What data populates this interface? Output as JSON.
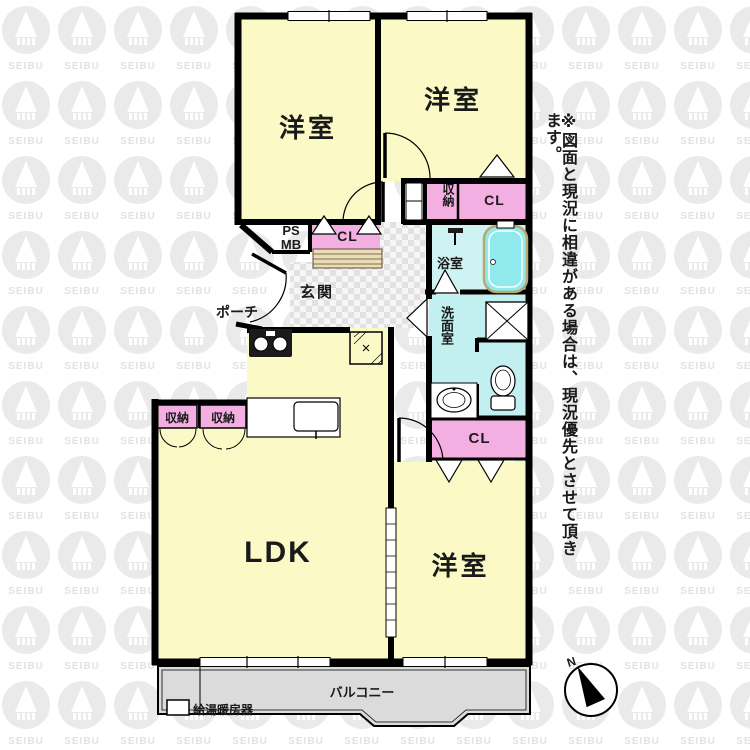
{
  "page": {
    "watermark_brand": "SEIBU"
  },
  "floorplan": {
    "rooms": {
      "bedroom_nw": {
        "label": "洋室"
      },
      "bedroom_ne": {
        "label": "洋室"
      },
      "bedroom_se": {
        "label": "洋室"
      },
      "ldk": {
        "label": "LDK"
      },
      "entrance": {
        "label": "玄関"
      },
      "porch": {
        "label": "ポーチ"
      },
      "bathroom": {
        "label": "浴室"
      },
      "washroom": {
        "label": "洗面室"
      },
      "balcony": {
        "label": "バルコニー"
      }
    },
    "storage": {
      "closet_ne": "CL",
      "closet_hall": "CL",
      "closet_se": "CL",
      "storage_hall": "収納",
      "storage_ldk_left": "収納",
      "storage_ldk_right": "収納",
      "pipe_space": "PS",
      "meter_box": "MB"
    },
    "equipment": {
      "water_heater": "給湯暖房器"
    },
    "compass": {
      "north": "N"
    },
    "colors": {
      "room_yellow": "#FBFAC6",
      "closet_pink": "#F3AEE2",
      "wet_area_cyan": "#C2EFEF",
      "bath_floor_cyan": "#CFF2F2",
      "bathtub_cyan": "#8FE9ED",
      "balcony_gray": "#DBDBDB",
      "wall_black": "#000000"
    }
  },
  "disclaimer": "※図面と現況に相違がある場合は、現況優先とさせて頂きます。"
}
